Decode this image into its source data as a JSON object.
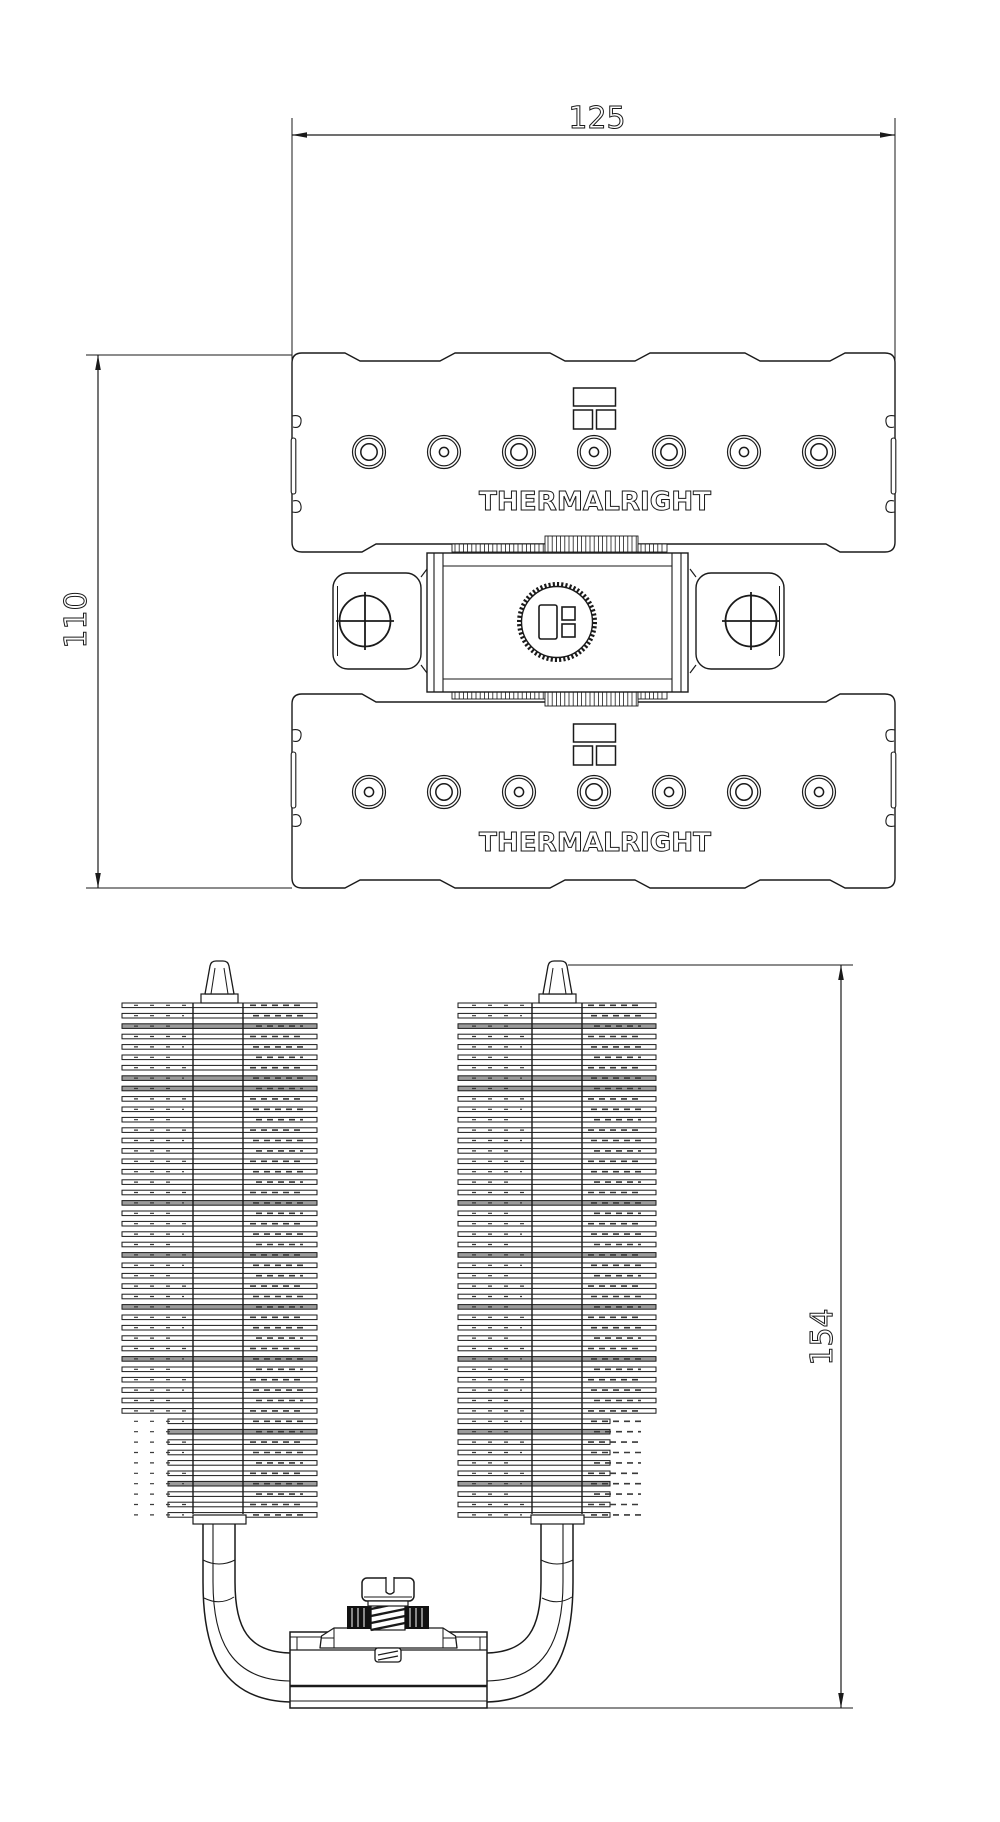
{
  "drawing": {
    "brand_text": "THERMALRIGHT",
    "dimensions": {
      "top_view_width_mm": "125",
      "top_view_height_mm": "110",
      "side_view_height_mm": "154"
    },
    "line_color": "#1a1a1a",
    "background_color": "#ffffff",
    "top_view": {
      "holes_per_row": 7,
      "hole_rows": 2,
      "edge_notches": 3,
      "phillips_screws": 2,
      "knurled_nut": 1,
      "logo_marks": 3
    },
    "side_view": {
      "fin_towers": 2,
      "fins_per_tower": 50,
      "heatpipes_visible": 2,
      "spring_screw": 1
    }
  }
}
